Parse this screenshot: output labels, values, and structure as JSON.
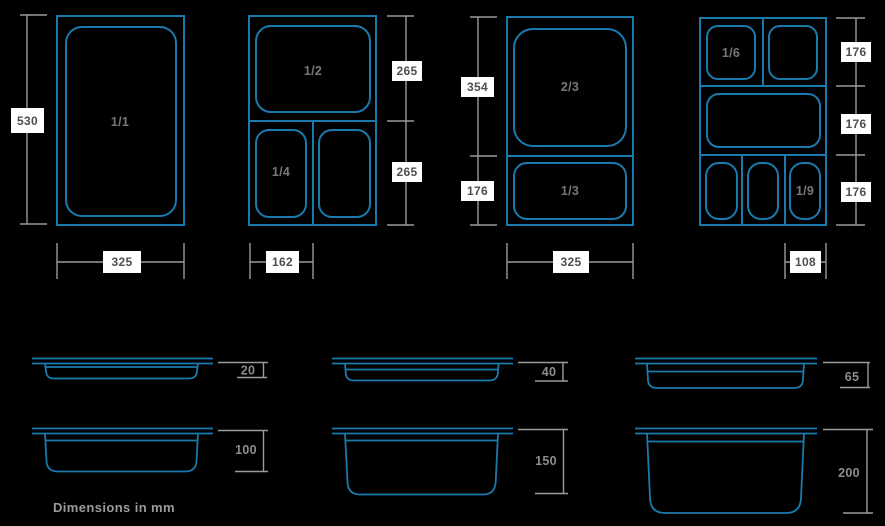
{
  "footnote": "Dimensions in mm",
  "colors": {
    "background": "#000000",
    "pan_stroke": "#1b7aad",
    "dim_line": "#9b9b9b",
    "dim_box_bg": "#ffffff",
    "dim_box_text": "#4e4e4e",
    "fraction_text": "#777777",
    "depth_text": "#8d8d8d"
  },
  "top_views": [
    {
      "fractions": [
        "1/1"
      ],
      "height": "530",
      "width": "325"
    },
    {
      "fractions": [
        "1/2",
        "1/4"
      ],
      "side_dims": [
        "265",
        "265"
      ],
      "width": "162"
    },
    {
      "fractions": [
        "2/3",
        "1/3"
      ],
      "side_dims": [
        "354",
        "176"
      ],
      "width": "325"
    },
    {
      "fractions": [
        "1/6",
        "1/9"
      ],
      "side_dims": [
        "176",
        "176",
        "176"
      ],
      "width": "108"
    }
  ],
  "side_views": {
    "depths": [
      "20",
      "100",
      "40",
      "150",
      "65",
      "200"
    ]
  }
}
